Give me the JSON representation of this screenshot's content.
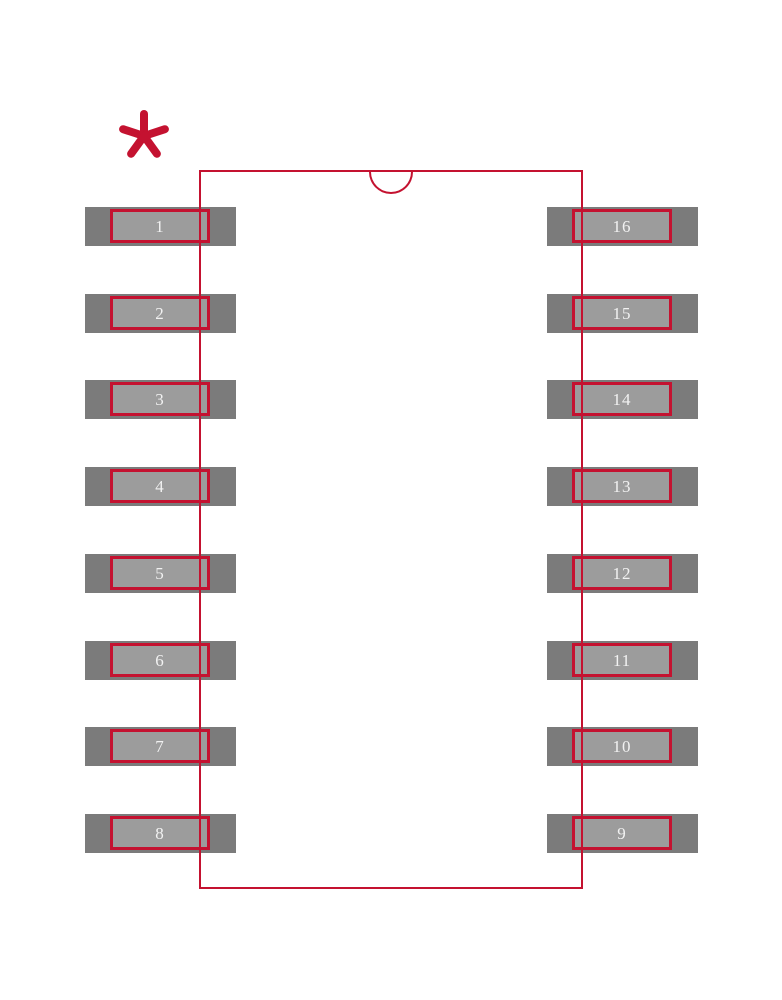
{
  "diagram": {
    "kind": "ic-footprint-land-pattern",
    "pin_count_text": "16",
    "pin1_marker": "*"
  },
  "colors": {
    "outline_red": "#c41230",
    "pad_gray": "#7b7b7b",
    "pad_inner_gray": "#9c9c9c",
    "pin_number_text": "#f2f2f2",
    "background": "#ffffff"
  },
  "pins": {
    "left": [
      {
        "label": "1"
      },
      {
        "label": "2"
      },
      {
        "label": "3"
      },
      {
        "label": "4"
      },
      {
        "label": "5"
      },
      {
        "label": "6"
      },
      {
        "label": "7"
      },
      {
        "label": "8"
      }
    ],
    "right": [
      {
        "label": "16"
      },
      {
        "label": "15"
      },
      {
        "label": "14"
      },
      {
        "label": "13"
      },
      {
        "label": "12"
      },
      {
        "label": "11"
      },
      {
        "label": "10"
      },
      {
        "label": "9"
      }
    ]
  }
}
